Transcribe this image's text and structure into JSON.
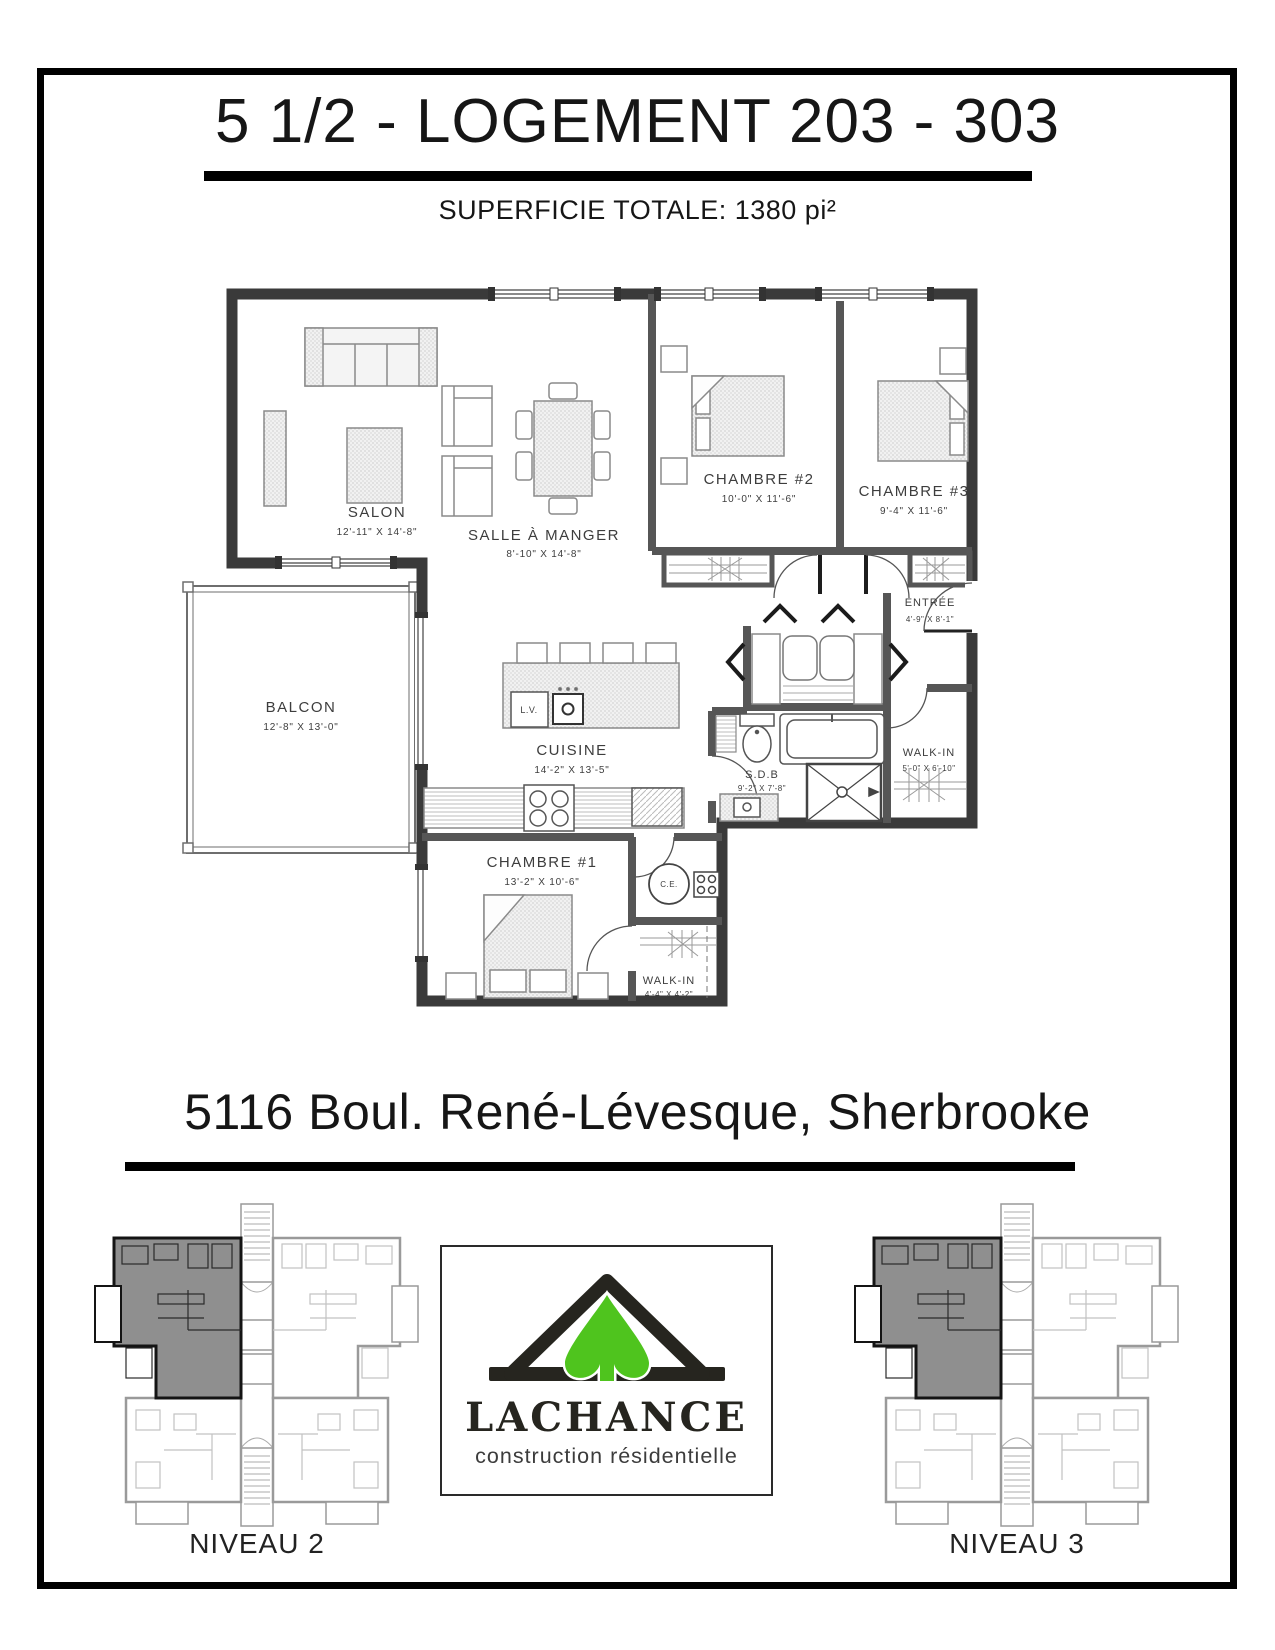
{
  "page": {
    "title": "5 1/2 - LOGEMENT 203 - 303",
    "subtitle": "SUPERFICIE TOTALE: 1380 pi²",
    "address": "5116 Boul. René-Lévesque, Sherbrooke"
  },
  "floorplan": {
    "rooms": [
      {
        "name": "SALON",
        "dims": "12'-11\" X 14'-8\""
      },
      {
        "name": "SALLE À MANGER",
        "dims": "8'-10\" X 14'-8\""
      },
      {
        "name": "CHAMBRE #2",
        "dims": "10'-0\" X 11'-6\""
      },
      {
        "name": "CHAMBRE #3",
        "dims": "9'-4\" X 11'-6\""
      },
      {
        "name": "ENTRÉE",
        "dims": "4'-9\" X 8'-1\""
      },
      {
        "name": "BALCON",
        "dims": "12'-8\" X 13'-0\""
      },
      {
        "name": "CUISINE",
        "dims": "14'-2\" X 13'-5\""
      },
      {
        "name": "S.D.B",
        "dims": "9'-2\" X 7'-8\""
      },
      {
        "name": "WALK-IN",
        "dims": "5'-0\" X 6'-10\""
      },
      {
        "name": "CHAMBRE #1",
        "dims": "13'-2\" X 10'-6\""
      },
      {
        "name": "WALK-IN",
        "dims": "4'-4\" X 4'-2\""
      }
    ],
    "appliances": {
      "lave_vaisselle": "L.V.",
      "chauffe_eau": "C.E."
    }
  },
  "logo": {
    "brand": "LACHANCE",
    "tagline": "construction résidentielle",
    "green": "#4fc41e",
    "dark": "#26251f"
  },
  "levels": [
    {
      "label": "NIVEAU 2"
    },
    {
      "label": "NIVEAU 3"
    }
  ]
}
